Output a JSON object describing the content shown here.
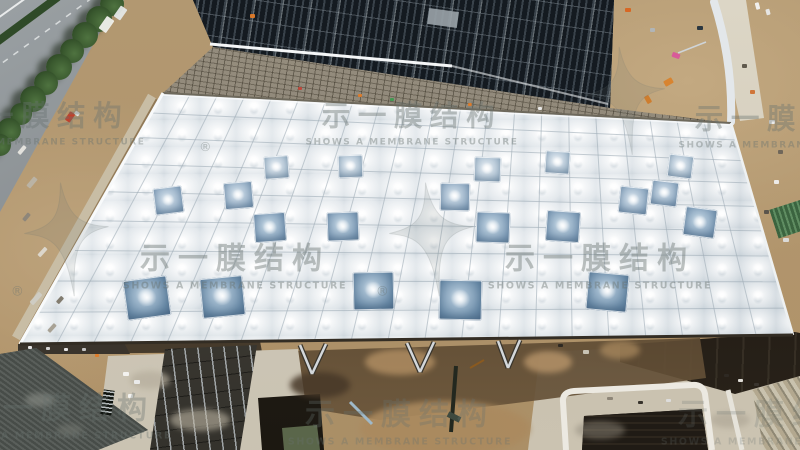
{
  "meta": {
    "type": "aerial drone photo",
    "subject": "membrane roof construction site",
    "width": 800,
    "height": 450
  },
  "watermark": {
    "text_cn": "示一膜结构",
    "text_en": "SHOWS A MEMBRANE STRUCTURE",
    "registered_mark": "®",
    "color": "#68726f",
    "instances": [
      {
        "x": 412,
        "y": 125,
        "scale": 0.95,
        "star": false,
        "reg": true,
        "opacity": 0.4
      },
      {
        "x": 235,
        "y": 268,
        "scale": 1.0,
        "star": true,
        "reg": true,
        "opacity": 0.42
      },
      {
        "x": 600,
        "y": 268,
        "scale": 1.0,
        "star": true,
        "reg": true,
        "opacity": 0.42
      },
      {
        "x": 39,
        "y": 125,
        "scale": 0.95,
        "star": false,
        "reg": false,
        "opacity": 0.38
      },
      {
        "x": 785,
        "y": 128,
        "scale": 0.95,
        "star": true,
        "reg": false,
        "opacity": 0.38
      },
      {
        "x": 60,
        "y": 418,
        "scale": 1.0,
        "star": true,
        "reg": false,
        "opacity": 0.34
      },
      {
        "x": 400,
        "y": 424,
        "scale": 1.0,
        "star": false,
        "reg": false,
        "opacity": 0.3
      },
      {
        "x": 773,
        "y": 424,
        "scale": 1.0,
        "star": false,
        "reg": false,
        "opacity": 0.22
      }
    ]
  },
  "palette": {
    "dirt": "#b29871",
    "road": "#84898d",
    "tree": "#39582e",
    "solar_panel": "#161c22",
    "membrane": "#f1f4f6",
    "grid_line": "#a4b0ba",
    "skylight_deep": "#4f6f8f",
    "skylight_light": "#9fb6c9",
    "concrete": "#c8c1b0",
    "shadow": "#17130e",
    "water": "#5a664a"
  },
  "roof": {
    "quad": {
      "tl": [
        163,
        93
      ],
      "tr": [
        731,
        123
      ],
      "br": [
        793,
        335
      ],
      "bl": [
        20,
        344
      ]
    },
    "columns": 21,
    "rows": 9,
    "line_color": "rgba(160,173,184,0.6)",
    "skylights": [
      [
        276,
        168,
        25,
        1
      ],
      [
        350,
        167,
        25,
        1
      ],
      [
        487,
        170,
        27,
        1
      ],
      [
        557,
        163,
        25,
        1
      ],
      [
        680,
        167,
        25,
        1
      ],
      [
        168,
        201,
        29,
        2
      ],
      [
        238,
        196,
        29,
        2
      ],
      [
        455,
        198,
        30,
        2
      ],
      [
        633,
        201,
        29,
        2
      ],
      [
        664,
        194,
        27,
        2
      ],
      [
        270,
        229,
        32,
        3
      ],
      [
        343,
        228,
        32,
        3
      ],
      [
        493,
        229,
        34,
        3
      ],
      [
        563,
        228,
        34,
        3
      ],
      [
        700,
        224,
        32,
        3
      ],
      [
        147,
        300,
        44,
        4
      ],
      [
        222,
        298,
        43,
        4
      ],
      [
        373,
        292,
        41,
        4
      ],
      [
        460,
        301,
        43,
        4
      ],
      [
        607,
        293,
        41,
        4
      ]
    ]
  },
  "trees": [
    [
      112,
      4,
      12
    ],
    [
      99,
      19,
      13
    ],
    [
      85,
      35,
      13
    ],
    [
      72,
      51,
      12
    ],
    [
      59,
      67,
      13
    ],
    [
      46,
      83,
      12
    ],
    [
      33,
      99,
      13
    ],
    [
      21,
      114,
      11
    ],
    [
      9,
      130,
      12
    ],
    [
      0,
      145,
      11
    ]
  ],
  "clutter": [
    [
      106,
      24,
      15,
      9,
      "#f0f0ec",
      -55
    ],
    [
      120,
      13,
      13,
      8,
      "#e4e7e6",
      -55
    ],
    [
      70,
      117,
      10,
      6,
      "#c23b28",
      -55
    ],
    [
      77,
      113,
      4,
      5,
      "#e8e8e8",
      -55
    ],
    [
      22,
      150,
      10,
      4,
      "#e8e6e0",
      -50
    ],
    [
      32,
      182,
      12,
      5,
      "#b9b4a8",
      -50
    ],
    [
      26,
      217,
      9,
      4,
      "#8b857a",
      -50
    ],
    [
      42,
      252,
      11,
      4,
      "#ddd9d0",
      -48
    ],
    [
      36,
      298,
      14,
      5,
      "#cfccc4",
      -48
    ],
    [
      52,
      328,
      10,
      4,
      "#a49e90",
      -48
    ],
    [
      60,
      300,
      8,
      4,
      "#7c7668",
      -48
    ],
    [
      300,
      88,
      4,
      3,
      "#c04438",
      0
    ],
    [
      360,
      95,
      4,
      3,
      "#e07b28",
      0
    ],
    [
      392,
      99,
      4,
      3,
      "#3f9950",
      0
    ],
    [
      470,
      104,
      4,
      3,
      "#e07b28",
      0
    ],
    [
      540,
      108,
      4,
      3,
      "#eeeeee",
      0
    ],
    [
      252,
      16,
      5,
      4,
      "#e07b28",
      0
    ],
    [
      628,
      10,
      6,
      4,
      "#d86420",
      0
    ],
    [
      652,
      30,
      5,
      4,
      "#b0b6ba",
      0
    ],
    [
      668,
      82,
      9,
      6,
      "#d9822b",
      -30
    ],
    [
      648,
      99,
      8,
      5,
      "#cf7a2a",
      60
    ],
    [
      676,
      55,
      8,
      5,
      "#d9569b",
      20
    ],
    [
      700,
      28,
      6,
      4,
      "#23313d",
      0
    ],
    [
      757,
      6,
      7,
      4,
      "#f2f3f3",
      75
    ],
    [
      768,
      12,
      6,
      4,
      "#e8e9e9",
      75
    ],
    [
      744,
      66,
      5,
      4,
      "#5a5347",
      0
    ],
    [
      752,
      92,
      5,
      4,
      "#d07030",
      0
    ],
    [
      772,
      122,
      6,
      4,
      "#eceded",
      0
    ],
    [
      780,
      152,
      5,
      4,
      "#6b6458",
      0
    ],
    [
      776,
      182,
      5,
      4,
      "#efefee",
      0
    ],
    [
      766,
      212,
      5,
      4,
      "#55504a",
      0
    ],
    [
      786,
      240,
      6,
      4,
      "#dddddd",
      0
    ],
    [
      726,
      375,
      5,
      3,
      "#2e2a24",
      0
    ],
    [
      740,
      380,
      5,
      3,
      "#e9e7e0",
      0
    ],
    [
      756,
      384,
      5,
      3,
      "#3a362f",
      0
    ],
    [
      610,
      398,
      6,
      3,
      "#8a8375",
      0
    ],
    [
      640,
      402,
      5,
      3,
      "#2e2a24",
      0
    ],
    [
      668,
      400,
      5,
      3,
      "#dddddd",
      0
    ],
    [
      126,
      374,
      6,
      4,
      "#f4f4f2",
      0
    ],
    [
      137,
      382,
      6,
      4,
      "#eceded",
      0
    ],
    [
      130,
      396,
      5,
      4,
      "#f4f4f2",
      0
    ],
    [
      97,
      355,
      4,
      3,
      "#e07b28",
      0
    ],
    [
      586,
      352,
      6,
      4,
      "#cfc9bb",
      0
    ],
    [
      560,
      345,
      5,
      3,
      "#2b2721",
      0
    ],
    [
      30,
      347,
      4,
      3,
      "#eeeeee",
      0
    ],
    [
      48,
      348,
      4,
      3,
      "#dddddd",
      0
    ],
    [
      66,
      349,
      4,
      3,
      "#eeeeee",
      0
    ],
    [
      84,
      349,
      4,
      3,
      "#cccccc",
      0
    ]
  ],
  "patches": [
    [
      400,
      362,
      70,
      26,
      "#b39064",
      0.8
    ],
    [
      548,
      362,
      48,
      22,
      "#b8956a",
      0.8
    ],
    [
      620,
      350,
      40,
      18,
      "#ad8c60",
      0.7
    ],
    [
      445,
      428,
      170,
      55,
      "#ab8a5f",
      0.9
    ],
    [
      320,
      385,
      60,
      26,
      "#473828",
      0.85
    ],
    [
      150,
      380,
      40,
      18,
      "#b5ad9c",
      0.7
    ],
    [
      200,
      420,
      60,
      22,
      "#beb6a4",
      0.6
    ],
    [
      40,
      400,
      30,
      14,
      "#7d817b",
      0.8
    ],
    [
      70,
      430,
      26,
      12,
      "#6f736d",
      0.7
    ],
    [
      600,
      430,
      50,
      18,
      "#8f887a",
      0.5
    ],
    [
      730,
      420,
      40,
      16,
      "#a59d8d",
      0.5
    ]
  ]
}
